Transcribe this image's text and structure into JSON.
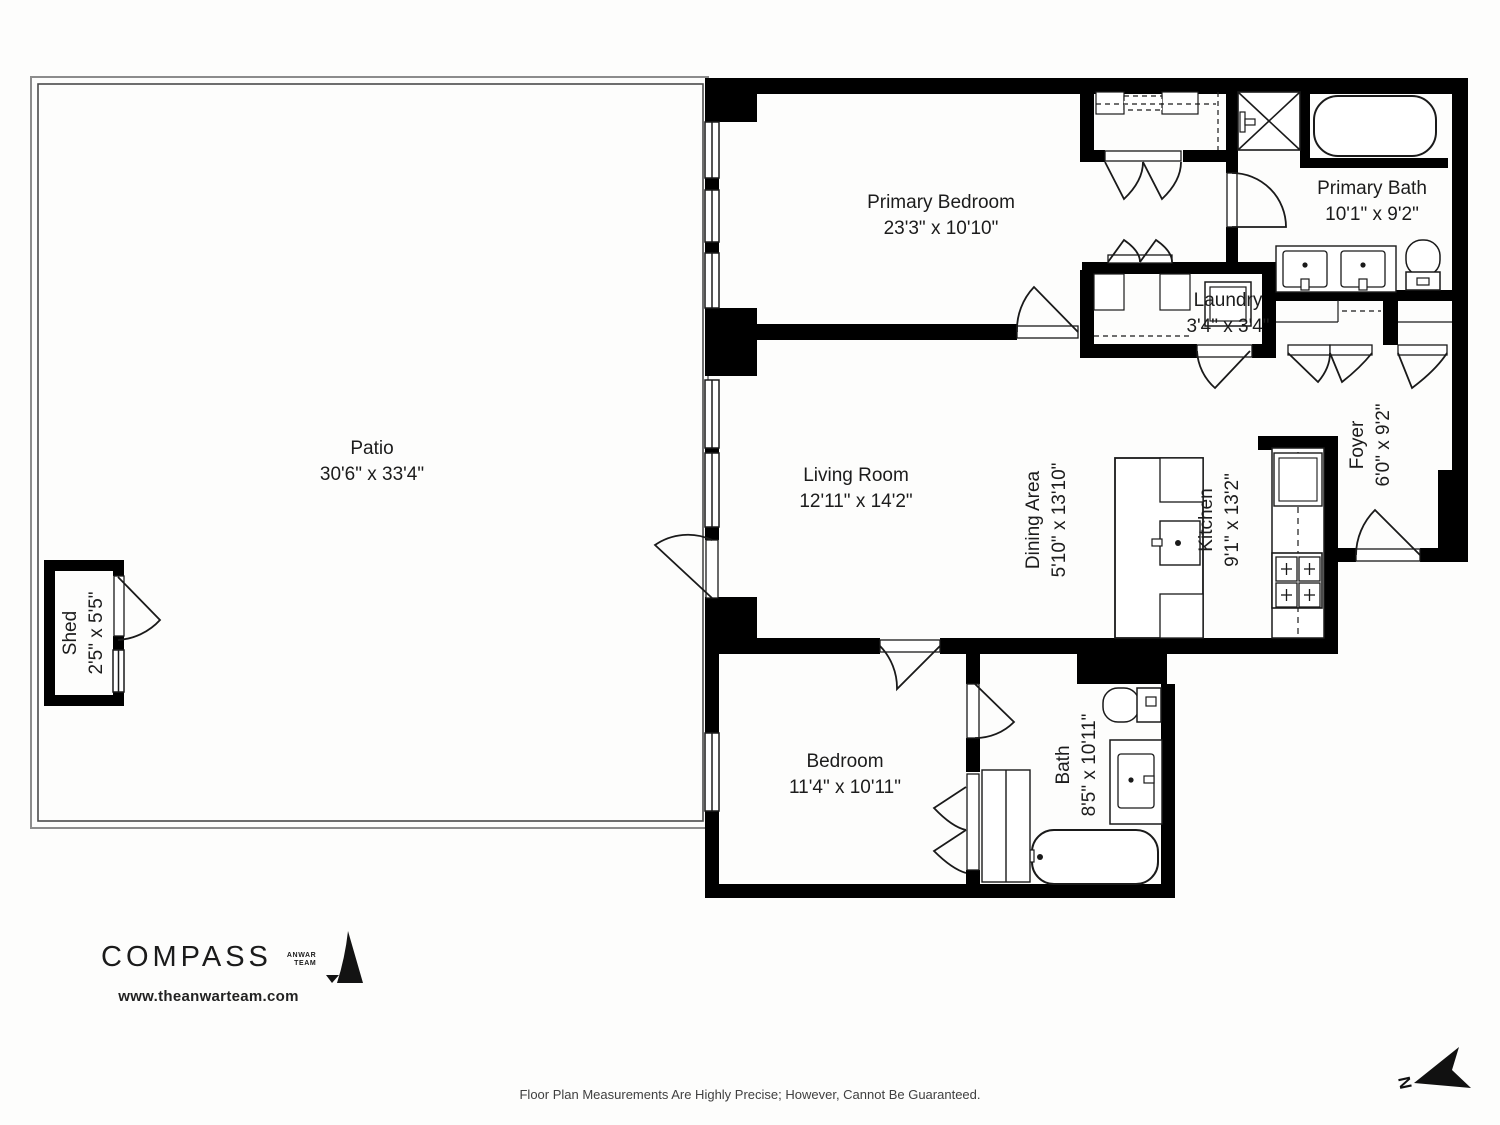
{
  "rooms": [
    {
      "id": "patio",
      "name": "Patio",
      "dims": "30'6\" x 33'4\""
    },
    {
      "id": "shed",
      "name": "Shed",
      "dims": "2'5\" x 5'5\""
    },
    {
      "id": "primary-bedroom",
      "name": "Primary Bedroom",
      "dims": "23'3\" x 10'10\""
    },
    {
      "id": "primary-bath",
      "name": "Primary Bath",
      "dims": "10'1\" x 9'2\""
    },
    {
      "id": "laundry",
      "name": "Laundry",
      "dims": "3'4\" x 3'4\""
    },
    {
      "id": "foyer",
      "name": "Foyer",
      "dims": "6'0\" x 9'2\""
    },
    {
      "id": "living-room",
      "name": "Living Room",
      "dims": "12'11\" x 14'2\""
    },
    {
      "id": "dining-area",
      "name": "Dining Area",
      "dims": "5'10\" x 13'10\""
    },
    {
      "id": "kitchen",
      "name": "Kitchen",
      "dims": "9'1\" x 13'2\""
    },
    {
      "id": "bedroom",
      "name": "Bedroom",
      "dims": "11'4\" x 10'11\""
    },
    {
      "id": "bath",
      "name": "Bath",
      "dims": "8'5\" x 10'11\""
    }
  ],
  "branding": {
    "compass": "COMPASS",
    "anwar_line1": "ANWAR",
    "anwar_line2": "TEAM",
    "website": "www.theanwarteam.com"
  },
  "footer": {
    "disclaimer": "Floor Plan Measurements Are Highly Precise; However, Cannot Be Guaranteed."
  },
  "north": {
    "label": "N"
  },
  "colors": {
    "wall": "#000000",
    "line": "#111111",
    "paper": "#fdfdfc"
  }
}
